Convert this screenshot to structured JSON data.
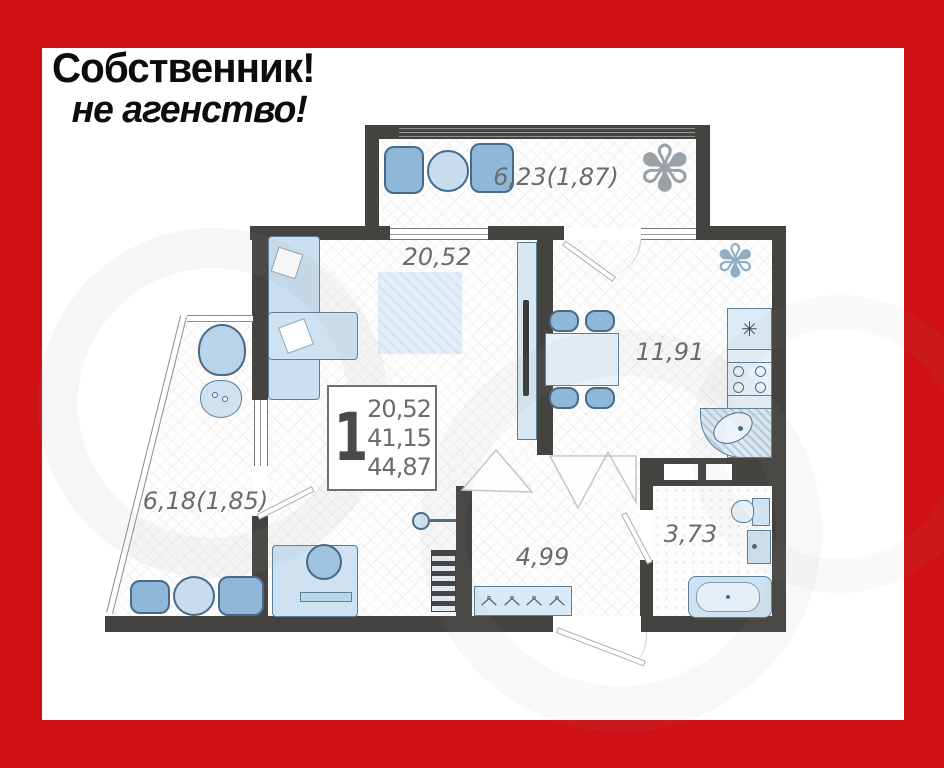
{
  "banner": {
    "line1": "Собственник!",
    "line2": "не агенство!"
  },
  "floor_plan": {
    "summary_box": {
      "rooms": "1",
      "living_area": "20,52",
      "total_area": "41,15",
      "total_with_balconies": "44,87"
    },
    "labels": {
      "balcony_top": "6,23(1,87)",
      "living_room": "20,52",
      "kitchen": "11,91",
      "balcony_left": "6,18(1,85)",
      "hallway": "4,99",
      "bathroom": "3,73"
    }
  },
  "icons": {
    "snowflake": "✳",
    "plant_large": "✾",
    "plant_small": "✾"
  },
  "colors": {
    "frame_red": "#cf1115",
    "wall": "#44433f",
    "furniture_fill": "#cfe2f1",
    "furniture_stroke": "#5b7e99",
    "chair_fill": "#8fb8d8",
    "label_gray": "#6b6b6b"
  }
}
